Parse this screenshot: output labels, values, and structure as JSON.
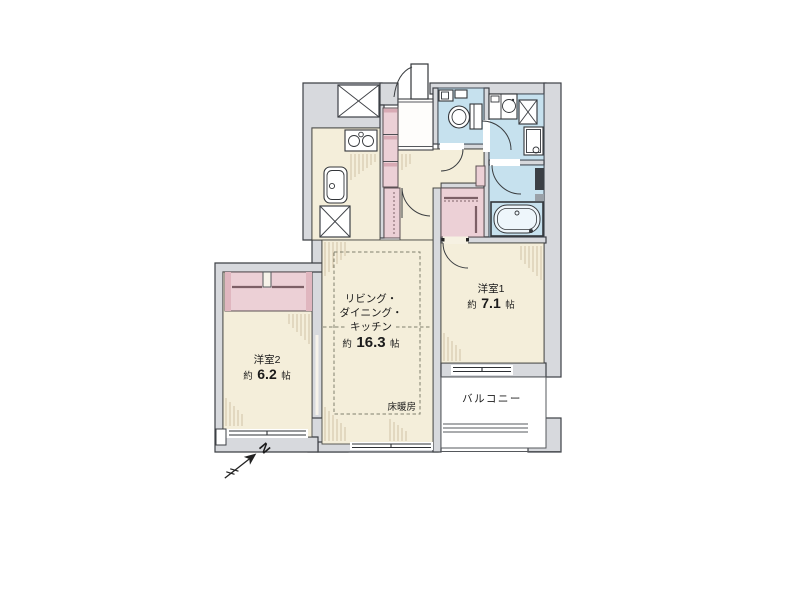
{
  "floor_plan": {
    "rooms": {
      "ldk": {
        "name_line1": "リビング・",
        "name_line2": "ダイニング・",
        "name_line3": "キッチン",
        "size_prefix": "約",
        "size_value": "16.3",
        "size_unit": "帖"
      },
      "bedroom1": {
        "name": "洋室1",
        "size_prefix": "約",
        "size_value": "7.1",
        "size_unit": "帖"
      },
      "bedroom2": {
        "name": "洋室2",
        "size_prefix": "約",
        "size_value": "6.2",
        "size_unit": "帖"
      },
      "balcony": {
        "label": "バルコニー"
      },
      "floor_heating_label": "床暖房"
    },
    "compass": {
      "north_label": "N"
    },
    "colors": {
      "wall": "#d7d9dd",
      "outline": "#3d4045",
      "room": "#f4eeda",
      "water": "#c6e1ee",
      "closet": "#ecd0d6",
      "hatch": "#c6b798"
    }
  }
}
